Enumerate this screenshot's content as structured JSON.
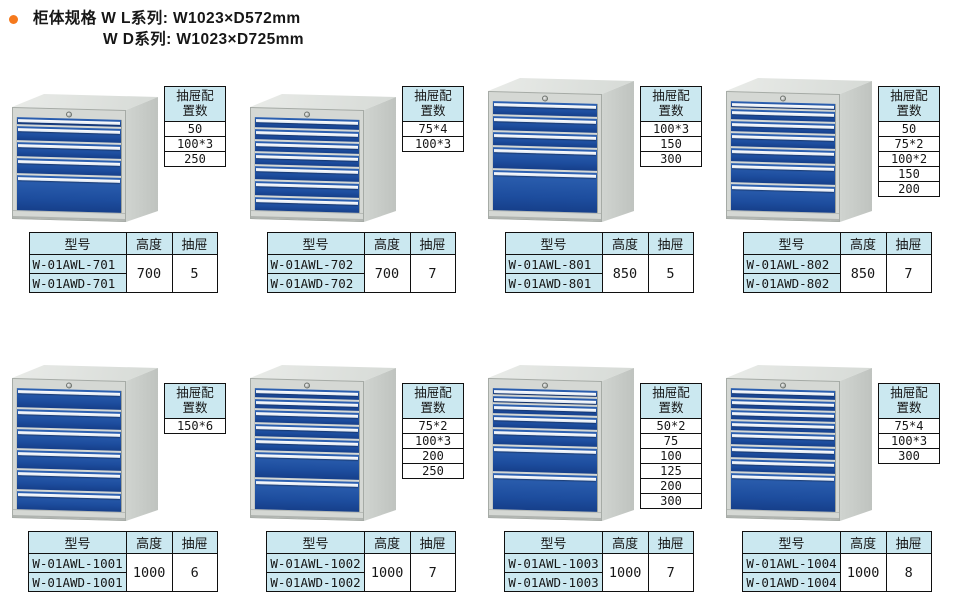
{
  "header": {
    "line1": "柜体规格 W L系列: W1023×D572mm",
    "line2": "W D系列: W1023×D725mm"
  },
  "labels": {
    "config_header_line1": "抽屉配",
    "config_header_line2": "置数",
    "model_col": "型号",
    "height_col": "高度",
    "drawer_col": "抽屉"
  },
  "colors": {
    "bullet": "#f5791d",
    "table_fill": "#cbe8f0",
    "table_border": "#101010",
    "drawer_blue": "#1d4d9e",
    "cabinet_gray": "#d5d8d4"
  },
  "products": [
    {
      "model_wl": "W-01AWL-701",
      "model_wd": "W-01AWD-701",
      "height": "700",
      "drawer_count": "5",
      "config_rows": [
        "50",
        "100*3",
        "250"
      ],
      "drawer_heights": [
        50,
        100,
        100,
        100,
        250
      ]
    },
    {
      "model_wl": "W-01AWL-702",
      "model_wd": "W-01AWD-702",
      "height": "700",
      "drawer_count": "7",
      "config_rows": [
        "75*4",
        "100*3"
      ],
      "drawer_heights": [
        75,
        75,
        75,
        75,
        100,
        100,
        100
      ]
    },
    {
      "model_wl": "W-01AWL-801",
      "model_wd": "W-01AWD-801",
      "height": "850",
      "drawer_count": "5",
      "config_rows": [
        "100*3",
        "150",
        "300"
      ],
      "drawer_heights": [
        100,
        100,
        100,
        150,
        300
      ]
    },
    {
      "model_wl": "W-01AWL-802",
      "model_wd": "W-01AWD-802",
      "height": "850",
      "drawer_count": "7",
      "config_rows": [
        "50",
        "75*2",
        "100*2",
        "150",
        "200"
      ],
      "drawer_heights": [
        50,
        75,
        75,
        100,
        100,
        150,
        200
      ]
    },
    {
      "model_wl": "W-01AWL-1001",
      "model_wd": "W-01AWD-1001",
      "height": "1000",
      "drawer_count": "6",
      "config_rows": [
        "150*6"
      ],
      "drawer_heights": [
        150,
        150,
        150,
        150,
        150,
        150
      ]
    },
    {
      "model_wl": "W-01AWL-1002",
      "model_wd": "W-01AWD-1002",
      "height": "1000",
      "drawer_count": "7",
      "config_rows": [
        "75*2",
        "100*3",
        "200",
        "250"
      ],
      "drawer_heights": [
        75,
        75,
        100,
        100,
        100,
        200,
        250
      ]
    },
    {
      "model_wl": "W-01AWL-1003",
      "model_wd": "W-01AWD-1003",
      "height": "1000",
      "drawer_count": "7",
      "config_rows": [
        "50*2",
        "75",
        "100",
        "125",
        "200",
        "300"
      ],
      "drawer_heights": [
        50,
        50,
        75,
        100,
        125,
        200,
        300
      ]
    },
    {
      "model_wl": "W-01AWL-1004",
      "model_wd": "W-01AWD-1004",
      "height": "1000",
      "drawer_count": "8",
      "config_rows": [
        "75*4",
        "100*3",
        "300"
      ],
      "drawer_heights": [
        75,
        75,
        75,
        75,
        100,
        100,
        100,
        300
      ]
    }
  ]
}
